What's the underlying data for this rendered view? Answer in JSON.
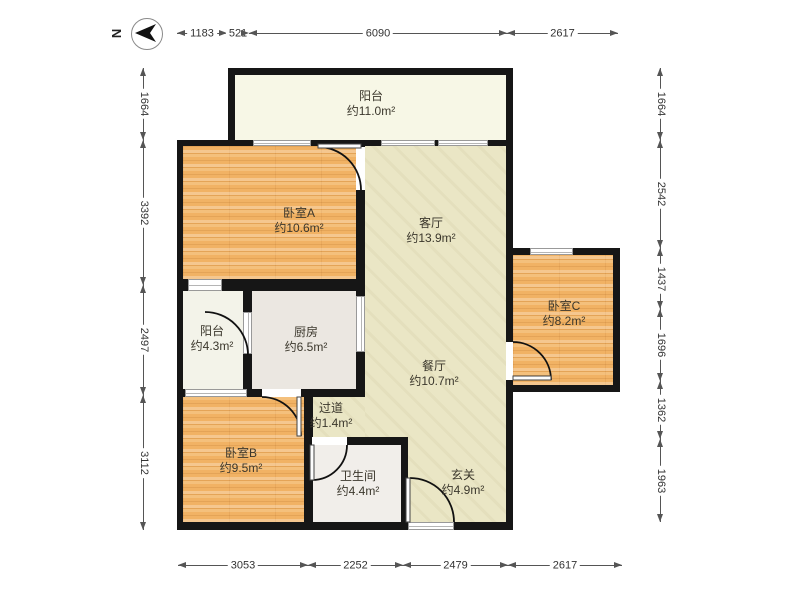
{
  "compass": {
    "label": "N"
  },
  "dimensions": {
    "top": [
      {
        "value": "1183"
      },
      {
        "value": "521"
      },
      {
        "value": "6090"
      },
      {
        "value": "2617"
      }
    ],
    "bottom": [
      {
        "value": "3053"
      },
      {
        "value": "2252"
      },
      {
        "value": "2479"
      },
      {
        "value": "2617"
      }
    ],
    "left": [
      {
        "value": "1664"
      },
      {
        "value": "3392"
      },
      {
        "value": "2497"
      },
      {
        "value": "3112"
      }
    ],
    "right": [
      {
        "value": "1664"
      },
      {
        "value": "2542"
      },
      {
        "value": "1437"
      },
      {
        "value": "1696"
      },
      {
        "value": "1362"
      },
      {
        "value": "1963"
      }
    ]
  },
  "rooms": [
    {
      "name": "阳台",
      "area": "约11.0m²"
    },
    {
      "name": "卧室A",
      "area": "约10.6m²"
    },
    {
      "name": "客厅",
      "area": "约13.9m²"
    },
    {
      "name": "卧室C",
      "area": "约8.2m²"
    },
    {
      "name": "阳台",
      "area": "约4.3m²"
    },
    {
      "name": "厨房",
      "area": "约6.5m²"
    },
    {
      "name": "餐厅",
      "area": "约10.7m²"
    },
    {
      "name": "过道",
      "area": "约1.4m²"
    },
    {
      "name": "卧室B",
      "area": "约9.5m²"
    },
    {
      "name": "卫生间",
      "area": "约4.4m²"
    },
    {
      "name": "玄关",
      "area": "约4.9m²"
    }
  ],
  "colors": {
    "wall": "#161616",
    "wood": "#f1b264",
    "living": "#eae6c5",
    "kitchen": "#ebe7e1",
    "bath": "#f1eeea",
    "balcony": "#f7f7e6",
    "dimension": "#555555"
  }
}
